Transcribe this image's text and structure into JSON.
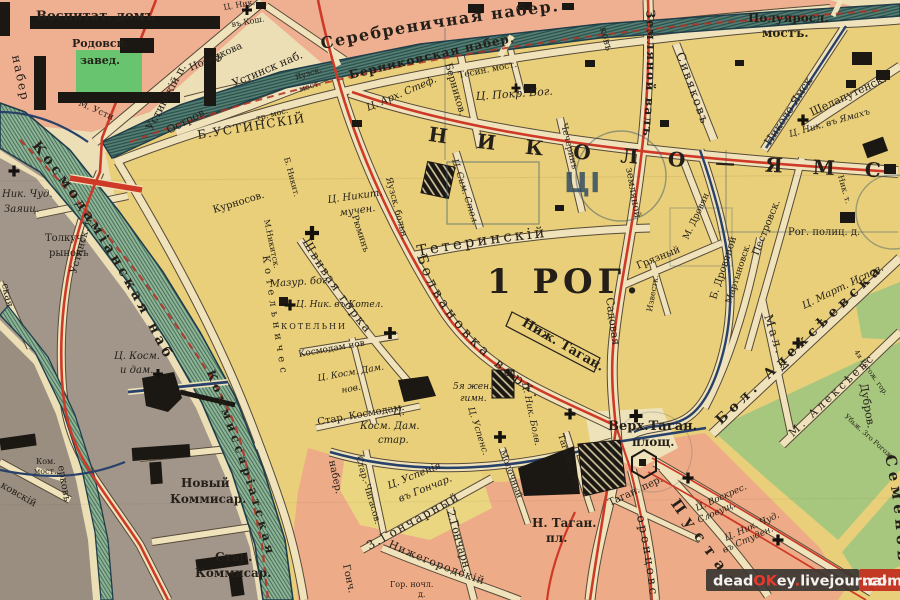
{
  "watermark": {
    "segments": [
      {
        "text": "dead",
        "color": "#f4f1ee"
      },
      {
        "text": "OK",
        "color": "#e8392e"
      },
      {
        "text": "ey",
        "color": "#f4f1ee"
      },
      {
        "text": ".",
        "color": "#e8392e"
      },
      {
        "text": "livejournal",
        "color": "#f4f1ee"
      }
    ],
    "domain_suffix": ".com"
  },
  "colors": {
    "paper": "#ecdfb6",
    "street": "#f0e3bb",
    "yellow_block": "#e9cf79",
    "pink_block": "#efb091",
    "gray_block": "#a2968a",
    "green_block": "#a8c77e",
    "moskva_river": "#8fb394",
    "yauza_river": "#577f74",
    "route_red": "#cf3a28",
    "route_blue": "#27416b",
    "ink": "#241f19",
    "watermark_bar": "#3a3531",
    "watermark_red": "#c2301f"
  },
  "ghost_mark": {
    "glyph": "ЦІ"
  },
  "district_number_label": "1 РОГ.",
  "labels": [
    {
      "t": "Воспитат. домъ",
      "x": 36,
      "y": 20,
      "s": 13,
      "cls": "b"
    },
    {
      "t": "Родовсп.",
      "x": 72,
      "y": 47,
      "s": 11,
      "cls": "b"
    },
    {
      "t": "завед.",
      "x": 80,
      "y": 64,
      "s": 11,
      "cls": "b"
    },
    {
      "t": "Ц. Ник.",
      "x": 224,
      "y": 10,
      "s": 8,
      "r": -10
    },
    {
      "t": "въ Кош.",
      "x": 232,
      "y": 27,
      "s": 8,
      "r": -10
    },
    {
      "t": "Устинскій п.",
      "x": 152,
      "y": 131,
      "s": 11,
      "r": -62
    },
    {
      "t": "Носенкова",
      "x": 191,
      "y": 71,
      "s": 10,
      "r": -24
    },
    {
      "t": "Устинск наб.",
      "x": 234,
      "y": 87,
      "s": 11,
      "r": -23
    },
    {
      "t": "Остров.",
      "x": 169,
      "y": 134,
      "s": 11,
      "r": -28
    },
    {
      "t": "тр. мос.",
      "x": 257,
      "y": 121,
      "s": 8,
      "r": -15
    },
    {
      "t": "Ф",
      "x": 214,
      "y": 62,
      "s": 10
    },
    {
      "t": "М. Усти",
      "x": 78,
      "y": 105,
      "s": 9,
      "r": 24
    },
    {
      "t": "Б.УСТИНСКІЙ",
      "x": 198,
      "y": 139,
      "s": 12,
      "r": -9,
      "sp": 1.5
    },
    {
      "t": "набер",
      "x": 12,
      "y": 56,
      "s": 12,
      "r": 78,
      "sp": 2
    },
    {
      "t": "Яузск.",
      "x": 296,
      "y": 80,
      "s": 8,
      "r": -18
    },
    {
      "t": "мост.",
      "x": 300,
      "y": 92,
      "s": 8,
      "r": -18
    },
    {
      "t": "Ц. Арх. Стеф.",
      "x": 368,
      "y": 111,
      "s": 10,
      "r": -23,
      "cls": "i"
    },
    {
      "t": "Тесин. мост.",
      "x": 459,
      "y": 78,
      "s": 9,
      "r": -11
    },
    {
      "t": "Ц. Покр. Бог.",
      "x": 476,
      "y": 100,
      "s": 11,
      "r": -4,
      "cls": "i"
    },
    {
      "t": "Берников.",
      "x": 445,
      "y": 64,
      "s": 10,
      "r": 74
    },
    {
      "t": "Серебреничная набер.",
      "p": "tp7",
      "s": 16,
      "sp": 1.5,
      "cls": "b"
    },
    {
      "t": "Берниковская набер.",
      "p": "tp8",
      "s": 12,
      "sp": 1,
      "cls": "b"
    },
    {
      "t": "Полуяросл.",
      "x": 748,
      "y": 22,
      "s": 12,
      "cls": "b"
    },
    {
      "t": "мостъ.",
      "x": 762,
      "y": 37,
      "s": 12,
      "cls": "b"
    },
    {
      "t": "Сивяковъ",
      "x": 676,
      "y": 54,
      "s": 12,
      "r": 70,
      "sp": 2
    },
    {
      "t": "Николо-Ямск",
      "x": 770,
      "y": 146,
      "s": 11,
      "r": -57
    },
    {
      "t": "Шелапутенск.",
      "x": 812,
      "y": 116,
      "s": 11,
      "r": -25
    },
    {
      "t": "Ц. Ник. въ Ямахъ",
      "x": 790,
      "y": 137,
      "s": 9,
      "r": -16,
      "cls": "i"
    },
    {
      "t": "ковъ",
      "x": 600,
      "y": 28,
      "s": 10,
      "r": 75
    },
    {
      "t": "Земляной валъ",
      "p": "tp16",
      "s": 12,
      "sp": 1.5,
      "cls": "b"
    },
    {
      "t": "земляной",
      "x": 626,
      "y": 168,
      "s": 10,
      "r": 80
    },
    {
      "t": "Садовая",
      "x": 606,
      "y": 298,
      "s": 11,
      "r": 82
    },
    {
      "t": "НИКОЛО—ЯМС",
      "p": "tp3",
      "s": 20,
      "sp": 30,
      "cls": "b",
      "c": "#2b3342"
    },
    {
      "t": "Тетеринскій",
      "p": "tp4",
      "s": 15,
      "sp": 3
    },
    {
      "t": "1 РОГ.",
      "x": 487,
      "y": 293,
      "s": 34,
      "sp": 5,
      "cls": "b",
      "c": "#1f2733"
    },
    {
      "t": "Чечеринъ",
      "x": 561,
      "y": 124,
      "s": 9,
      "r": 76
    },
    {
      "t": "Ц. Сим. Стол.",
      "x": 452,
      "y": 160,
      "s": 9,
      "r": 72,
      "cls": "i"
    },
    {
      "t": "Ц. Никит.",
      "x": 328,
      "y": 203,
      "s": 10,
      "r": -8,
      "cls": "i"
    },
    {
      "t": "мучен.",
      "x": 340,
      "y": 216,
      "s": 10,
      "r": -8,
      "cls": "i"
    },
    {
      "t": "Рюминъ",
      "x": 352,
      "y": 216,
      "s": 9,
      "r": 72
    },
    {
      "t": "Яузск. больн.",
      "x": 386,
      "y": 178,
      "s": 9,
      "r": 75
    },
    {
      "t": "Б. Никит.",
      "x": 284,
      "y": 158,
      "s": 8,
      "r": 75
    },
    {
      "t": "М.Никитск.",
      "x": 264,
      "y": 220,
      "s": 8,
      "r": 78
    },
    {
      "t": "Курносов.",
      "x": 214,
      "y": 213,
      "s": 10,
      "r": -17
    },
    {
      "t": "Мазур. бог.",
      "x": 270,
      "y": 287,
      "s": 10,
      "r": -4,
      "cls": "i"
    },
    {
      "t": "Ц. Ник. въ Котел.",
      "x": 296,
      "y": 307,
      "s": 9,
      "cls": "i"
    },
    {
      "t": "КОТЕЛЬНИ",
      "x": 281,
      "y": 329,
      "s": 8,
      "sp": 2
    },
    {
      "t": "Котельничес",
      "p": "tp17",
      "s": 10,
      "sp": 5
    },
    {
      "t": "Космодам нов",
      "x": 299,
      "y": 357,
      "s": 9,
      "r": -10
    },
    {
      "t": "Ц. Косм. Дам.",
      "x": 318,
      "y": 381,
      "s": 9,
      "r": -10,
      "cls": "i"
    },
    {
      "t": "нов.",
      "x": 342,
      "y": 393,
      "s": 9,
      "r": -10,
      "cls": "i"
    },
    {
      "t": "Стар. Космодам.",
      "x": 318,
      "y": 425,
      "s": 10,
      "r": -10
    },
    {
      "t": "Ц.",
      "x": 393,
      "y": 415,
      "s": 10,
      "cls": "i"
    },
    {
      "t": "Косм. Дам.",
      "x": 360,
      "y": 429,
      "s": 10,
      "cls": "i"
    },
    {
      "t": "стар.",
      "x": 378,
      "y": 443,
      "s": 10,
      "cls": "i"
    },
    {
      "t": "Швивая горка",
      "p": "tp6",
      "s": 12,
      "sp": 2
    },
    {
      "t": "Болвановка верх.",
      "p": "tp5",
      "s": 14,
      "sp": 4
    },
    {
      "t": "Ниж. Таган.",
      "x": 521,
      "y": 325,
      "s": 13,
      "r": 30,
      "cls": "b"
    },
    {
      "t": "5я жен.",
      "x": 453,
      "y": 389,
      "s": 9,
      "cls": "i"
    },
    {
      "t": "гимн.",
      "x": 460,
      "y": 401,
      "s": 9,
      "cls": "i"
    },
    {
      "t": "Ц. Успенс.",
      "x": 468,
      "y": 408,
      "s": 9,
      "r": 72,
      "cls": "i"
    },
    {
      "t": "Ц. Ник. Болв.",
      "x": 522,
      "y": 383,
      "s": 9,
      "r": 78,
      "cls": "i"
    },
    {
      "t": "Молочный",
      "x": 500,
      "y": 451,
      "s": 9,
      "r": 70
    },
    {
      "t": "Таганск. пр.",
      "x": 558,
      "y": 435,
      "s": 9,
      "r": 72
    },
    {
      "t": "Стар.-Чигасов.",
      "x": 356,
      "y": 457,
      "s": 9,
      "r": 74
    },
    {
      "t": "Ц. Успенія",
      "x": 389,
      "y": 489,
      "s": 10,
      "r": -22,
      "cls": "i"
    },
    {
      "t": "въ Гончар.",
      "x": 400,
      "y": 502,
      "s": 10,
      "r": -22,
      "cls": "i"
    },
    {
      "t": "3.Гончарный",
      "p": "tp15",
      "s": 12,
      "sp": 2
    },
    {
      "t": "2.Гончарн.",
      "x": 447,
      "y": 511,
      "s": 11,
      "r": 74
    },
    {
      "t": "Нижегородскій",
      "p": "tp14",
      "s": 11,
      "sp": 1
    },
    {
      "t": "Гор. ночл.",
      "x": 390,
      "y": 587,
      "s": 8
    },
    {
      "t": "д.",
      "x": 418,
      "y": 597,
      "s": 8
    },
    {
      "t": "набер.",
      "x": 329,
      "y": 461,
      "s": 10,
      "r": 78
    },
    {
      "t": "Гонч.",
      "x": 343,
      "y": 565,
      "s": 10,
      "r": 78
    },
    {
      "t": "Верх.Таган.",
      "x": 608,
      "y": 430,
      "s": 13,
      "cls": "b"
    },
    {
      "t": "площ.",
      "x": 632,
      "y": 446,
      "s": 12,
      "cls": "b"
    },
    {
      "t": "Н. Таган.",
      "x": 532,
      "y": 527,
      "s": 12,
      "cls": "b"
    },
    {
      "t": "пл.",
      "x": 546,
      "y": 542,
      "s": 12,
      "cls": "b"
    },
    {
      "t": "Таган. пер.",
      "x": 610,
      "y": 506,
      "s": 10,
      "r": -25
    },
    {
      "t": "Ц. Воскрес.",
      "x": 697,
      "y": 511,
      "s": 9,
      "r": -24,
      "cls": "i"
    },
    {
      "t": "Словущ.",
      "x": 699,
      "y": 523,
      "s": 9,
      "r": -24,
      "cls": "i"
    },
    {
      "t": "Ц. Ник. Чуд.",
      "x": 726,
      "y": 541,
      "s": 9,
      "r": -24,
      "cls": "i"
    },
    {
      "t": "въ Студен.",
      "x": 724,
      "y": 553,
      "s": 9,
      "r": -24,
      "cls": "i"
    },
    {
      "t": "Семеновс",
      "p": "tp11",
      "s": 15,
      "sp": 5,
      "cls": "b"
    },
    {
      "t": "Пустая",
      "p": "tp12",
      "s": 15,
      "sp": 8,
      "cls": "b"
    },
    {
      "t": "оронцовс",
      "p": "tp13",
      "s": 12,
      "sp": 3
    },
    {
      "t": "Бол. Алексѣевска",
      "p": "tp9",
      "s": 14,
      "sp": 5,
      "cls": "b"
    },
    {
      "t": "М. Алексѣевс",
      "p": "tp10",
      "s": 11,
      "sp": 3
    },
    {
      "t": "Мал. А",
      "x": 764,
      "y": 316,
      "s": 12,
      "r": 72,
      "sp": 3
    },
    {
      "t": "Ц. Март. Испов.",
      "x": 804,
      "y": 309,
      "s": 10,
      "r": -26,
      "cls": "i"
    },
    {
      "t": "Рог. полиц. д.",
      "x": 788,
      "y": 235,
      "s": 10
    },
    {
      "t": "Ник. т.",
      "x": 838,
      "y": 176,
      "s": 8,
      "r": 74
    },
    {
      "t": "Грязный",
      "x": 638,
      "y": 269,
      "s": 10,
      "r": -22
    },
    {
      "t": "М. Дровян.",
      "x": 688,
      "y": 240,
      "s": 9,
      "r": -65
    },
    {
      "t": "Б. Дровяной",
      "x": 716,
      "y": 300,
      "s": 10,
      "r": -72
    },
    {
      "t": "Известк.",
      "x": 652,
      "y": 312,
      "s": 8,
      "r": -80
    },
    {
      "t": "Мартыновск.",
      "x": 731,
      "y": 304,
      "s": 9,
      "r": -72
    },
    {
      "t": "Пестровск.",
      "x": 758,
      "y": 256,
      "s": 10,
      "r": -68
    },
    {
      "t": "Устинск. п.",
      "x": 76,
      "y": 274,
      "s": 10,
      "r": -74
    },
    {
      "t": "Толкуч.",
      "x": 45,
      "y": 241,
      "s": 10
    },
    {
      "t": "рынокъ",
      "x": 49,
      "y": 256,
      "s": 10
    },
    {
      "t": "Ник. Чуд.",
      "x": 2,
      "y": 197,
      "s": 10,
      "cls": "i"
    },
    {
      "t": "Заяиц.",
      "x": 4,
      "y": 212,
      "s": 10,
      "cls": "i"
    },
    {
      "t": "Космодамiанская наб",
      "p": "tp1",
      "s": 14,
      "sp": 4,
      "cls": "b",
      "o": 18
    },
    {
      "t": "Коммиссаріатская",
      "p": "tp2",
      "s": 12,
      "sp": 4,
      "cls": "b"
    },
    {
      "t": "Новый",
      "x": 181,
      "y": 487,
      "s": 12,
      "cls": "b"
    },
    {
      "t": "Коммисар.",
      "x": 170,
      "y": 503,
      "s": 12,
      "cls": "b"
    },
    {
      "t": "Стар.",
      "x": 215,
      "y": 561,
      "s": 12,
      "cls": "b"
    },
    {
      "t": "Коммисар.",
      "x": 195,
      "y": 577,
      "s": 12,
      "cls": "b"
    },
    {
      "t": "Ком.",
      "x": 36,
      "y": 464,
      "s": 8
    },
    {
      "t": "мост.",
      "x": 34,
      "y": 474,
      "s": 8
    },
    {
      "t": "ковскій",
      "x": 0,
      "y": 487,
      "s": 10,
      "r": 30
    },
    {
      "t": "ерковъ",
      "x": 58,
      "y": 466,
      "s": 10,
      "r": 80
    },
    {
      "t": "ская",
      "x": 2,
      "y": 284,
      "s": 10,
      "r": 78
    },
    {
      "t": "4я Рогож. гор.",
      "x": 854,
      "y": 352,
      "s": 7,
      "r": 55
    },
    {
      "t": "Убьж. 3го Рогож.",
      "x": 844,
      "y": 417,
      "s": 7,
      "r": 42
    },
    {
      "t": "Дубров.",
      "x": 860,
      "y": 384,
      "s": 11,
      "r": 80
    },
    {
      "t": "Ц. Косм.",
      "x": 114,
      "y": 359,
      "s": 10,
      "cls": "i"
    },
    {
      "t": "и дам.",
      "x": 120,
      "y": 373,
      "s": 10,
      "cls": "i"
    },
    {
      "t": "ЦІ",
      "x": 564,
      "y": 192,
      "s": 28,
      "cls": "g"
    }
  ],
  "churches": [
    {
      "x": 247,
      "y": 10,
      "s": 10
    },
    {
      "x": 14,
      "y": 171,
      "s": 11
    },
    {
      "x": 516,
      "y": 88,
      "s": 9
    },
    {
      "x": 312,
      "y": 233,
      "s": 14
    },
    {
      "x": 290,
      "y": 305,
      "s": 11
    },
    {
      "x": 390,
      "y": 333,
      "s": 12
    },
    {
      "x": 500,
      "y": 437,
      "s": 12
    },
    {
      "x": 570,
      "y": 414,
      "s": 11
    },
    {
      "x": 636,
      "y": 416,
      "s": 13
    },
    {
      "x": 688,
      "y": 478,
      "s": 11
    },
    {
      "x": 778,
      "y": 540,
      "s": 11
    },
    {
      "x": 803,
      "y": 120,
      "s": 11
    },
    {
      "x": 798,
      "y": 343,
      "s": 11
    },
    {
      "x": 158,
      "y": 374,
      "s": 10
    }
  ]
}
